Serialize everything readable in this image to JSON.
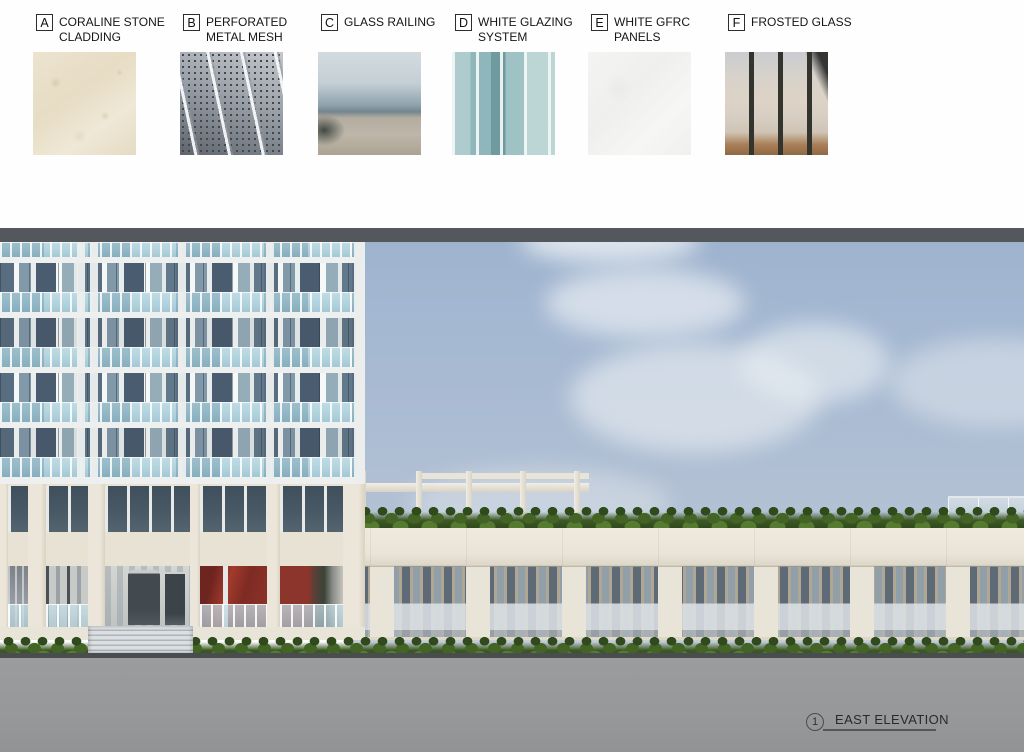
{
  "legend": {
    "materials": [
      {
        "id": "A",
        "name": "CORALINE STONE CLADDING",
        "x": 33
      },
      {
        "id": "B",
        "name": "PERFORATED METAL MESH",
        "x": 180
      },
      {
        "id": "C",
        "name": "GLASS RAILING",
        "x": 318
      },
      {
        "id": "D",
        "name": "WHITE GLAZING SYSTEM",
        "x": 452
      },
      {
        "id": "E",
        "name": "WHITE GFRC PANELS",
        "x": 588
      },
      {
        "id": "F",
        "name": "FROSTED GLASS",
        "x": 725
      }
    ]
  },
  "callouts": [
    {
      "letter": "A",
      "x": 54,
      "drop_y": 538
    },
    {
      "letter": "C",
      "x": 110,
      "drop_y": 414
    },
    {
      "letter": "D",
      "x": 148,
      "drop_y": 596
    },
    {
      "letter": "C",
      "x": 229,
      "drop_y": 618
    },
    {
      "letter": "A",
      "x": 256,
      "drop_y": 632
    },
    {
      "letter": "E",
      "x": 288,
      "drop_y": 423
    },
    {
      "letter": "A",
      "x": 478,
      "drop_y": 583
    },
    {
      "letter": "B",
      "x": 591,
      "drop_y": 582
    },
    {
      "letter": "A",
      "x": 765,
      "drop_y": 538
    },
    {
      "letter": "B",
      "x": 806,
      "drop_y": 583
    },
    {
      "letter": "A",
      "x": 941,
      "drop_y": 538
    },
    {
      "letter": "C",
      "x": 991,
      "drop_y": 507
    }
  ],
  "title_block": {
    "view_number": "1",
    "view_title": "EAST ELEVATION"
  },
  "colors": {
    "paper": "#fefefe",
    "sky_top": "#9db2cd",
    "top_band": "#54575b",
    "stone": "#e9e4d8",
    "tower_glass": "#54687a",
    "railing_glass": "#a4cbd8",
    "mesh_dark": "#5e6b76",
    "hedge_green": "#446426",
    "ground_gray": "#9b9c9d",
    "storefront_red": "#8d342a"
  }
}
